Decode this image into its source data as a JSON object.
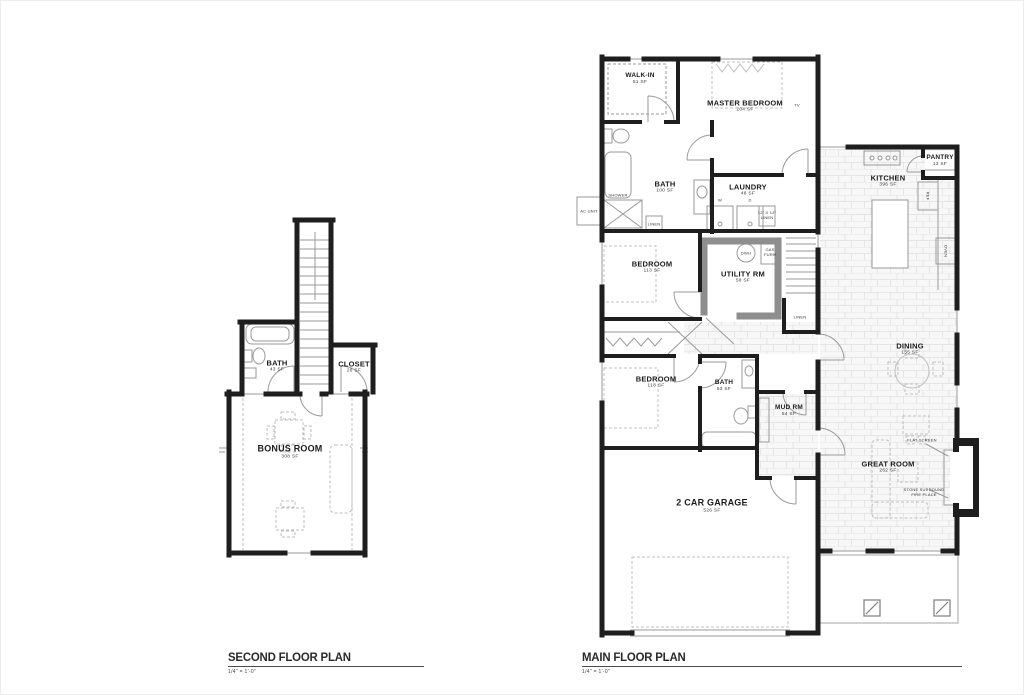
{
  "colors": {
    "wall": "#1e1e1e",
    "thin_line": "#9a9a9a",
    "fixture": "#b5b5b5",
    "tile_line": "#dedede",
    "utility_wall": "#8e8e8e",
    "page": "#ffffff"
  },
  "second_floor": {
    "title": "SECOND FLOOR PLAN",
    "scale": "1/4\" = 1'-0\"",
    "rooms": {
      "bath": {
        "name": "BATH",
        "area": "43 SF"
      },
      "closet": {
        "name": "CLOSET",
        "area": "26 SF"
      },
      "bonus": {
        "name": "BONUS ROOM",
        "area": "308 SF"
      }
    }
  },
  "main_floor": {
    "title": "MAIN FLOOR PLAN",
    "scale": "1/4\" = 1'-0\"",
    "rooms": {
      "walkin": {
        "name": "WALK-IN",
        "area": "51 SF"
      },
      "master": {
        "name": "MASTER BEDROOM",
        "area": "204 SF"
      },
      "bath1": {
        "name": "BATH",
        "area": "100 SF"
      },
      "laundry": {
        "name": "LAUNDRY",
        "area": "48 SF"
      },
      "kitchen": {
        "name": "KITCHEN",
        "area": "396 SF"
      },
      "pantry": {
        "name": "PANTRY",
        "area": "13 SF"
      },
      "bedroom1": {
        "name": "BEDROOM",
        "area": "113 SF"
      },
      "utility": {
        "name": "UTILITY RM",
        "area": "58 SF"
      },
      "bedroom2": {
        "name": "BEDROOM",
        "area": "118 SF"
      },
      "bath2": {
        "name": "BATH",
        "area": "53 SF"
      },
      "mud": {
        "name": "MUD RM",
        "area": "54 SF"
      },
      "garage": {
        "name": "2 CAR GARAGE",
        "area": "526 SF"
      },
      "dining": {
        "name": "DINING",
        "area": "155 SF"
      },
      "great": {
        "name": "GREAT ROOM",
        "area": "262 SF"
      }
    },
    "annotations": {
      "ac_unit": "AC UNIT",
      "shower": "SHOWER",
      "linen1": "LINEN",
      "linen2": "LINEN",
      "linen_shelf": "12\" X 12\"\nLINEN",
      "washer": "W",
      "dryer": "D",
      "dwh": "DWH",
      "gas_furn": "GAS\nFURN",
      "ref": "REF",
      "oven": "OVEN",
      "tv": "TV",
      "flat_screen": "FLAT SCREEN",
      "fireplace_note": "STONE SURROUND\nFIRE PLACE"
    }
  }
}
